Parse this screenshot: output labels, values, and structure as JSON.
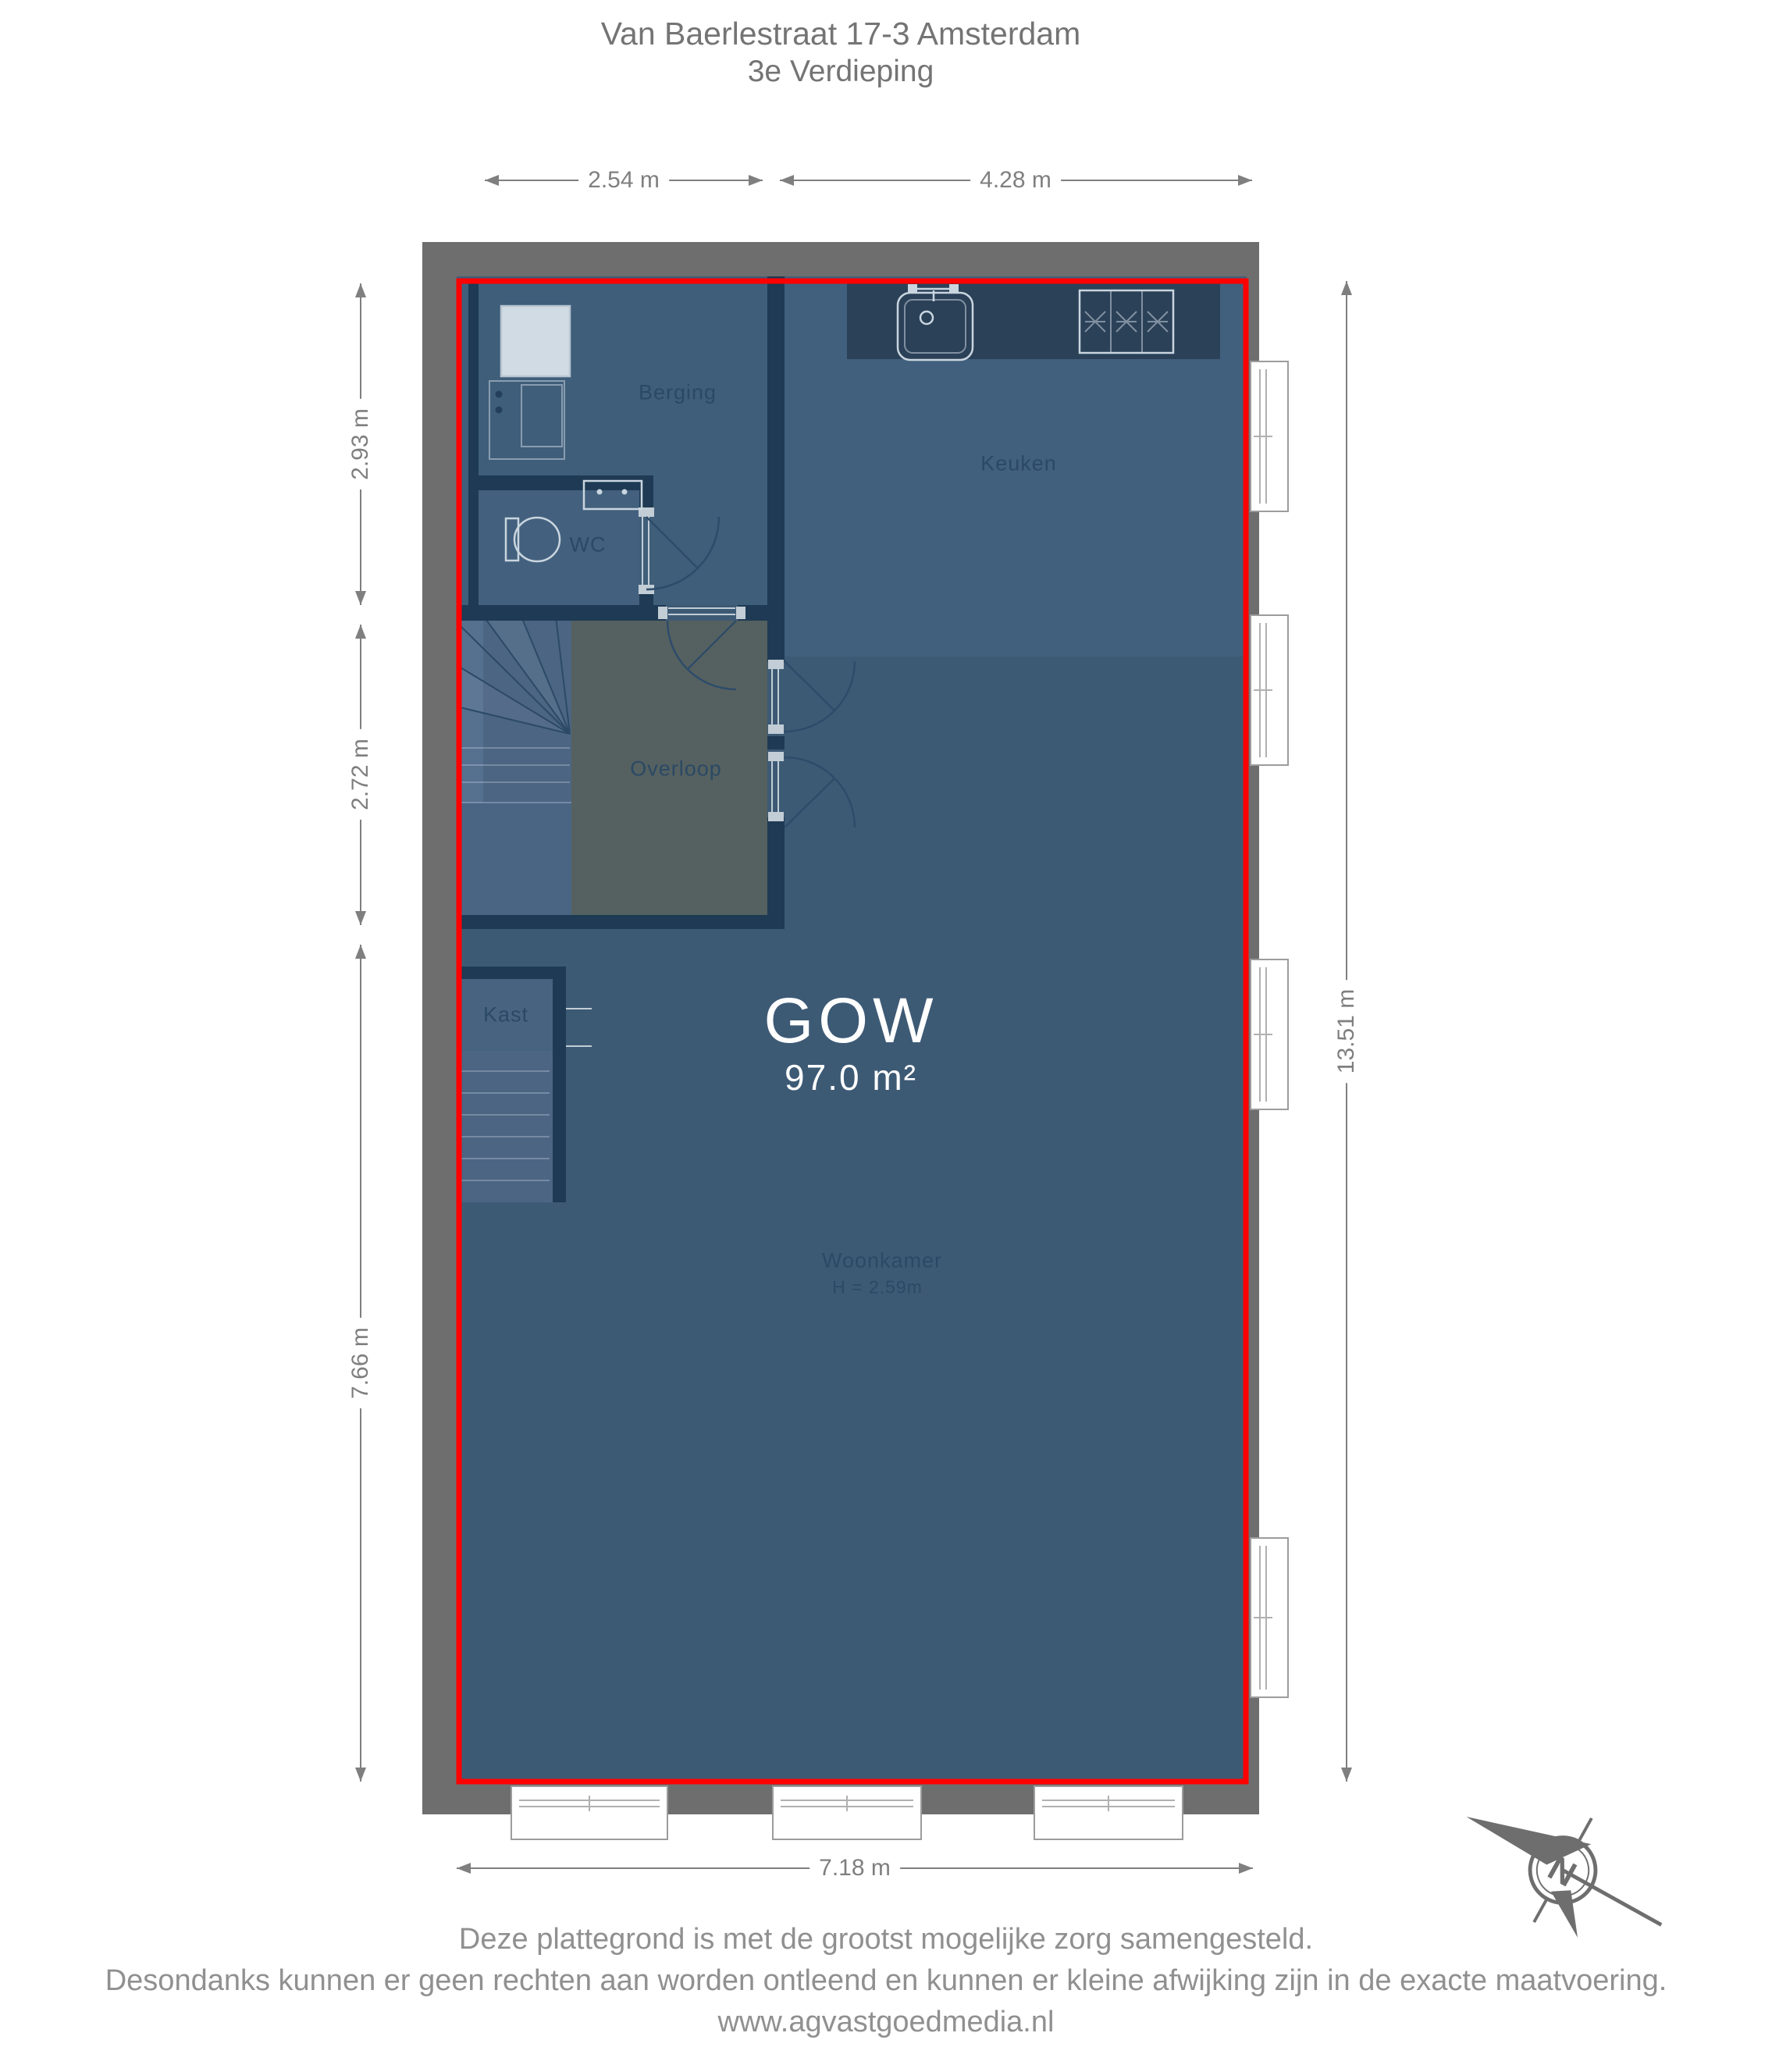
{
  "title": {
    "line1": "Van Baerlestraat 17-3 Amsterdam",
    "line2": "3e Verdieping"
  },
  "rooms": {
    "berging": "Berging",
    "wc": "WC",
    "keuken": "Keuken",
    "overloop": "Overloop",
    "kast": "Kast",
    "woonkamer": "Woonkamer",
    "woonkamer_ceiling_height": "H = 2.59m"
  },
  "gow": {
    "label": "GOW",
    "area": "97.0 m²"
  },
  "dimensions": {
    "berging_width": "2.54 m",
    "keuken_width": "4.28 m",
    "berging_depth": "2.93 m",
    "overloop_depth": "2.72 m",
    "woonkamer_depth": "7.66 m",
    "total_depth": "13.51 m",
    "total_width": "7.18 m"
  },
  "compass": {
    "north": "N"
  },
  "footer": {
    "line1": "Deze plattegrond is met de grootst mogelijke zorg samengesteld.",
    "line2": "Desondanks kunnen er geen rechten aan worden ontleend en kunnen er kleine afwijking zijn in de exacte maatvoering.",
    "line3": "www.agvastgoedmedia.nl"
  },
  "colors": {
    "wall-gray": "#6e6e6e",
    "floor-blue": "#3d5a75",
    "floor-keuken": "#41607d",
    "floor-berging": "#3f5e7a",
    "floor-wc": "#43617e",
    "counter-dark": "#2b4158",
    "floor-overloop": "#556160",
    "floor-stairs": "#4b6583",
    "floor-stairs-light": "#567090",
    "floor-landing": "#4a6584",
    "floor-kast": "#476380",
    "wall-navy": "#1e3a54",
    "outline-red": "#ff0000",
    "dim-gray": "#7f7f7f",
    "room-label": "#2b4965",
    "title-gray": "#747474",
    "footer-gray": "#909090"
  }
}
